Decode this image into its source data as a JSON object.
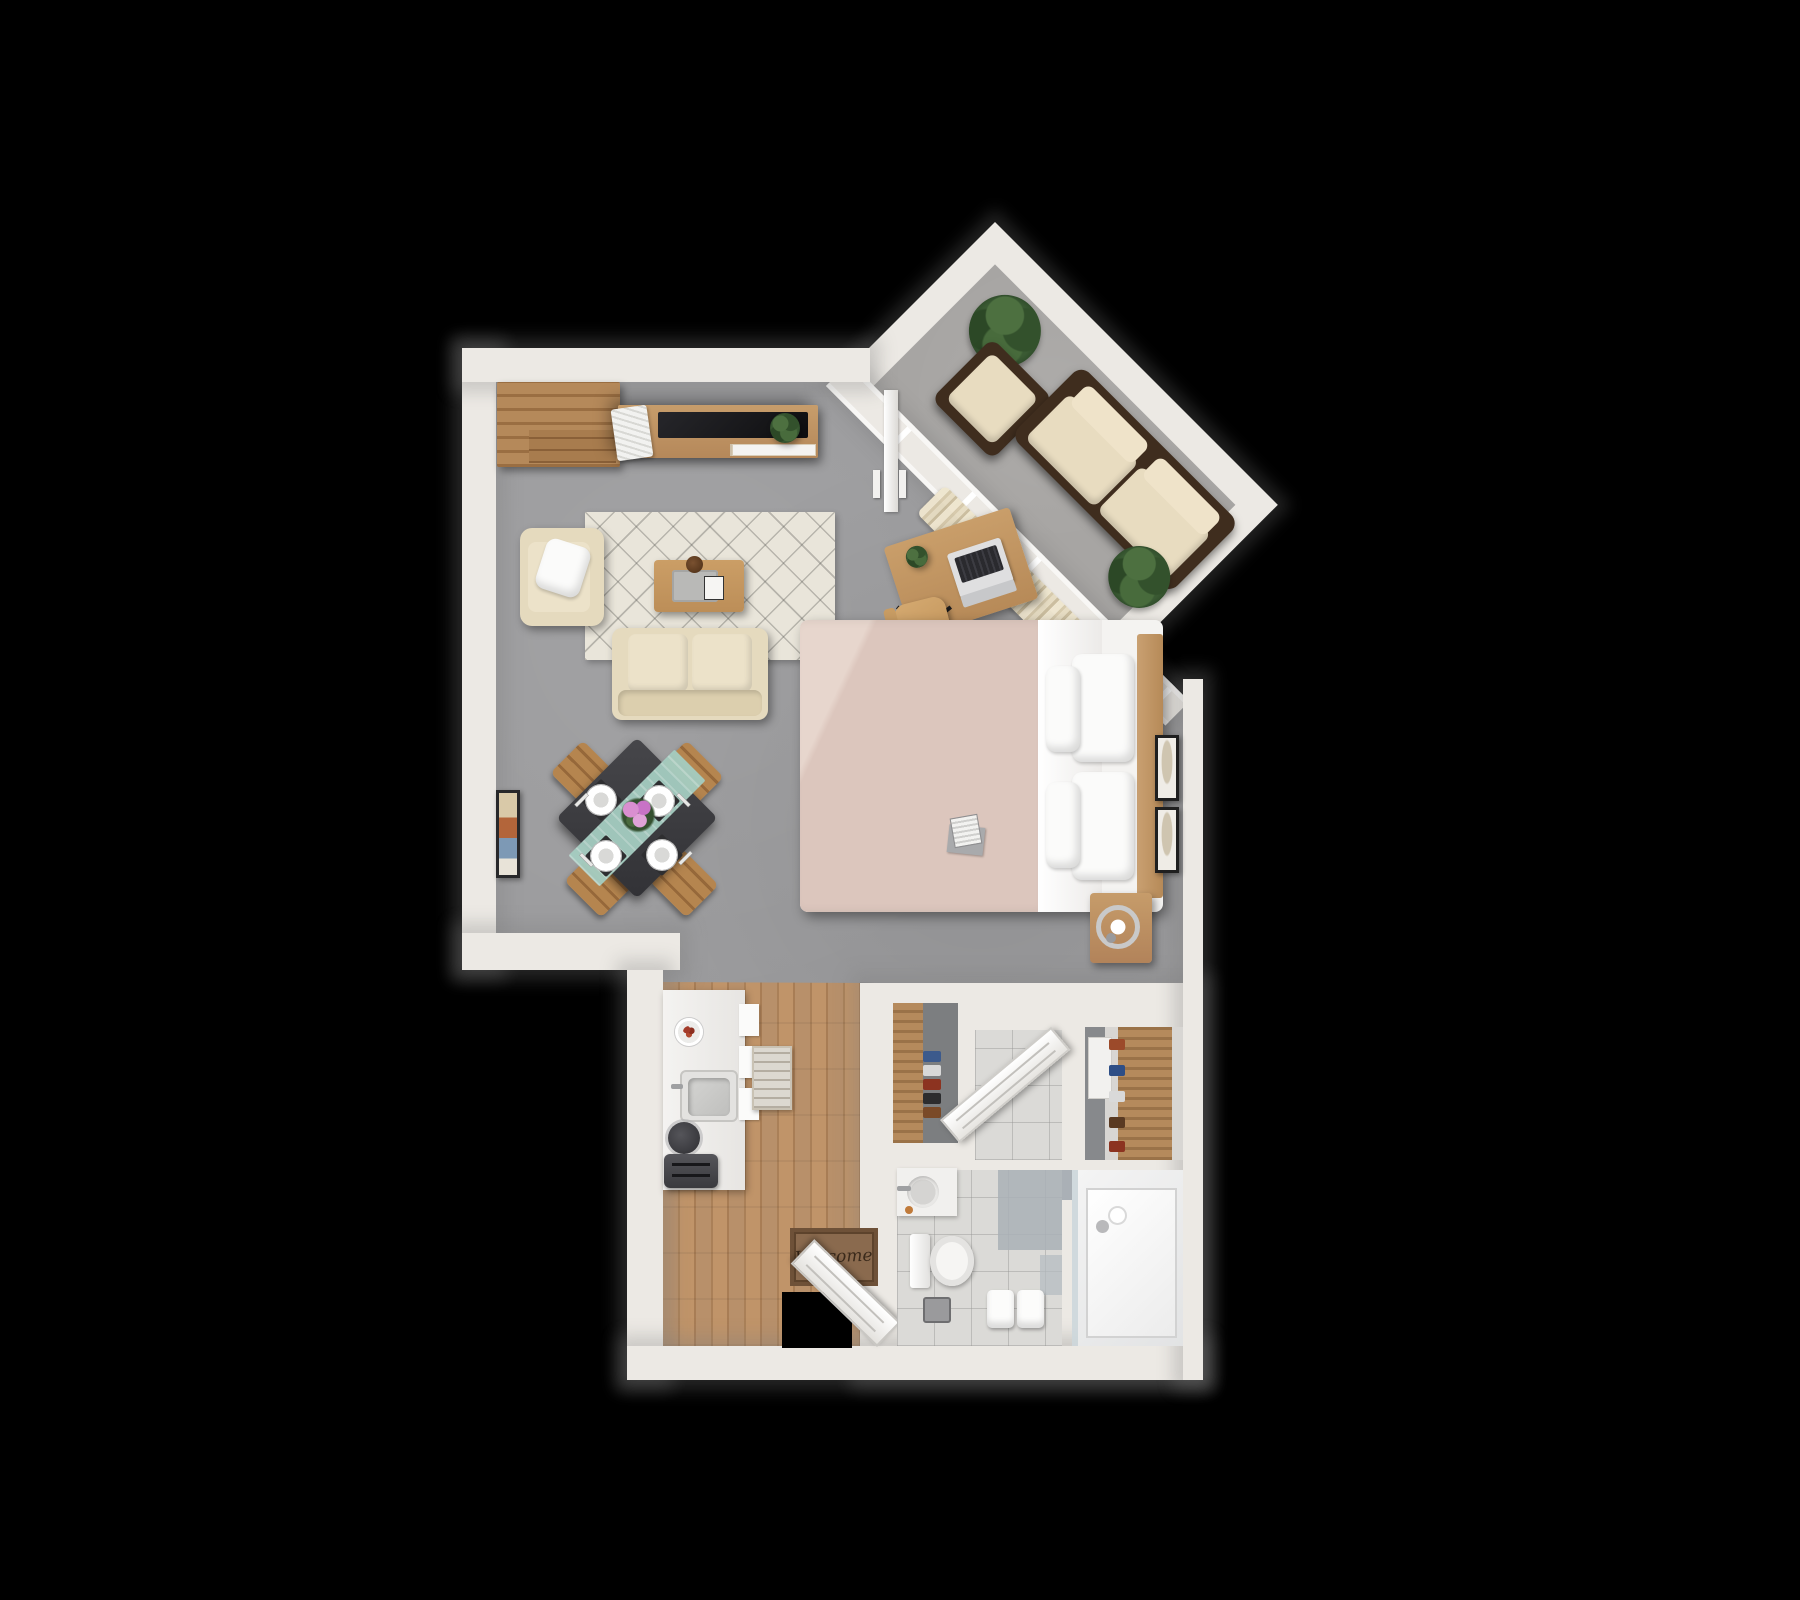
{
  "scene": {
    "description": "3D top-down rendered floor plan of a studio apartment on a black background",
    "background": "#000000"
  },
  "doormat": {
    "text": "Welcome"
  },
  "palette": {
    "bg": "#000000",
    "wall": "#ece9e4",
    "wallShadow": "#7d7d7f",
    "floorConcrete": "#9c9c9e",
    "floorWood": "#b48a60",
    "floorTile": "#dbdad7",
    "balconyFloor": "#a7a5a3",
    "rug": "#e9e5da",
    "sofa": "#e5dabe",
    "woodFurniture": "#c39764",
    "darkWood": "#3f2d1e",
    "tv": "#151517",
    "duvet": "#dcc6bd",
    "linen": "#fbfbfa",
    "curtain": "#e6dcc2",
    "plant": "#3a5a33",
    "diningTable": "#3c3c3f",
    "teal": "#a5cdc1",
    "accentTerracotta": "#a33b2a"
  },
  "rooms": [
    {
      "name": "living-room",
      "furniture": [
        "corner storage cabinet",
        "tv media console",
        "flat-screen tv",
        "magazine stack",
        "potted plant",
        "cream loveseat sofa",
        "cream armchair with throw pillow",
        "patterned area rug",
        "wood coffee table with tray, card and bowl",
        "framed wall art"
      ]
    },
    {
      "name": "dining-area",
      "furniture": [
        "square dark dining table (rotated 45°)",
        "4 wooden chairs",
        "4 white place settings with cutlery",
        "teal table runner",
        "pink flower centerpiece"
      ]
    },
    {
      "name": "office-nook",
      "furniture": [
        "wood desk",
        "open laptop",
        "small desk plant",
        "wood office chair on casters"
      ]
    },
    {
      "name": "bedroom-area",
      "furniture": [
        "double bed with blush duvet and white sheets",
        "wood headboard",
        "4 white pillows",
        "book and radio on bed",
        "wood nightstand with ring lamp",
        "2 framed artworks",
        "cream curtains along angled window wall",
        "sliding glass door"
      ]
    },
    {
      "name": "balcony",
      "furniture": [
        "outdoor sofa with dark frame and cream cushions",
        "outdoor armchair",
        "2 potted plants"
      ]
    },
    {
      "name": "kitchen",
      "furniture": [
        "white counter",
        "square sink with faucet",
        "black kettle",
        "toaster",
        "plate with food",
        "wall shelves",
        "small runner rug",
        "wood plank flooring"
      ]
    },
    {
      "name": "entry",
      "furniture": [
        "open front door",
        "welcome doormat",
        "shoe closet with wood rack and shoes"
      ]
    },
    {
      "name": "bathroom",
      "furniture": [
        "vanity sink with faucet and soap",
        "toilet",
        "step stool",
        "towel bench with two white towels",
        "gray accent tiles"
      ]
    },
    {
      "name": "shower-room",
      "furniture": [
        "walk-in shower",
        "glass panel",
        "pendant lights"
      ]
    },
    {
      "name": "wardrobe-closet",
      "furniture": [
        "white cabinet",
        "wood clothes rack",
        "shoes"
      ]
    }
  ]
}
